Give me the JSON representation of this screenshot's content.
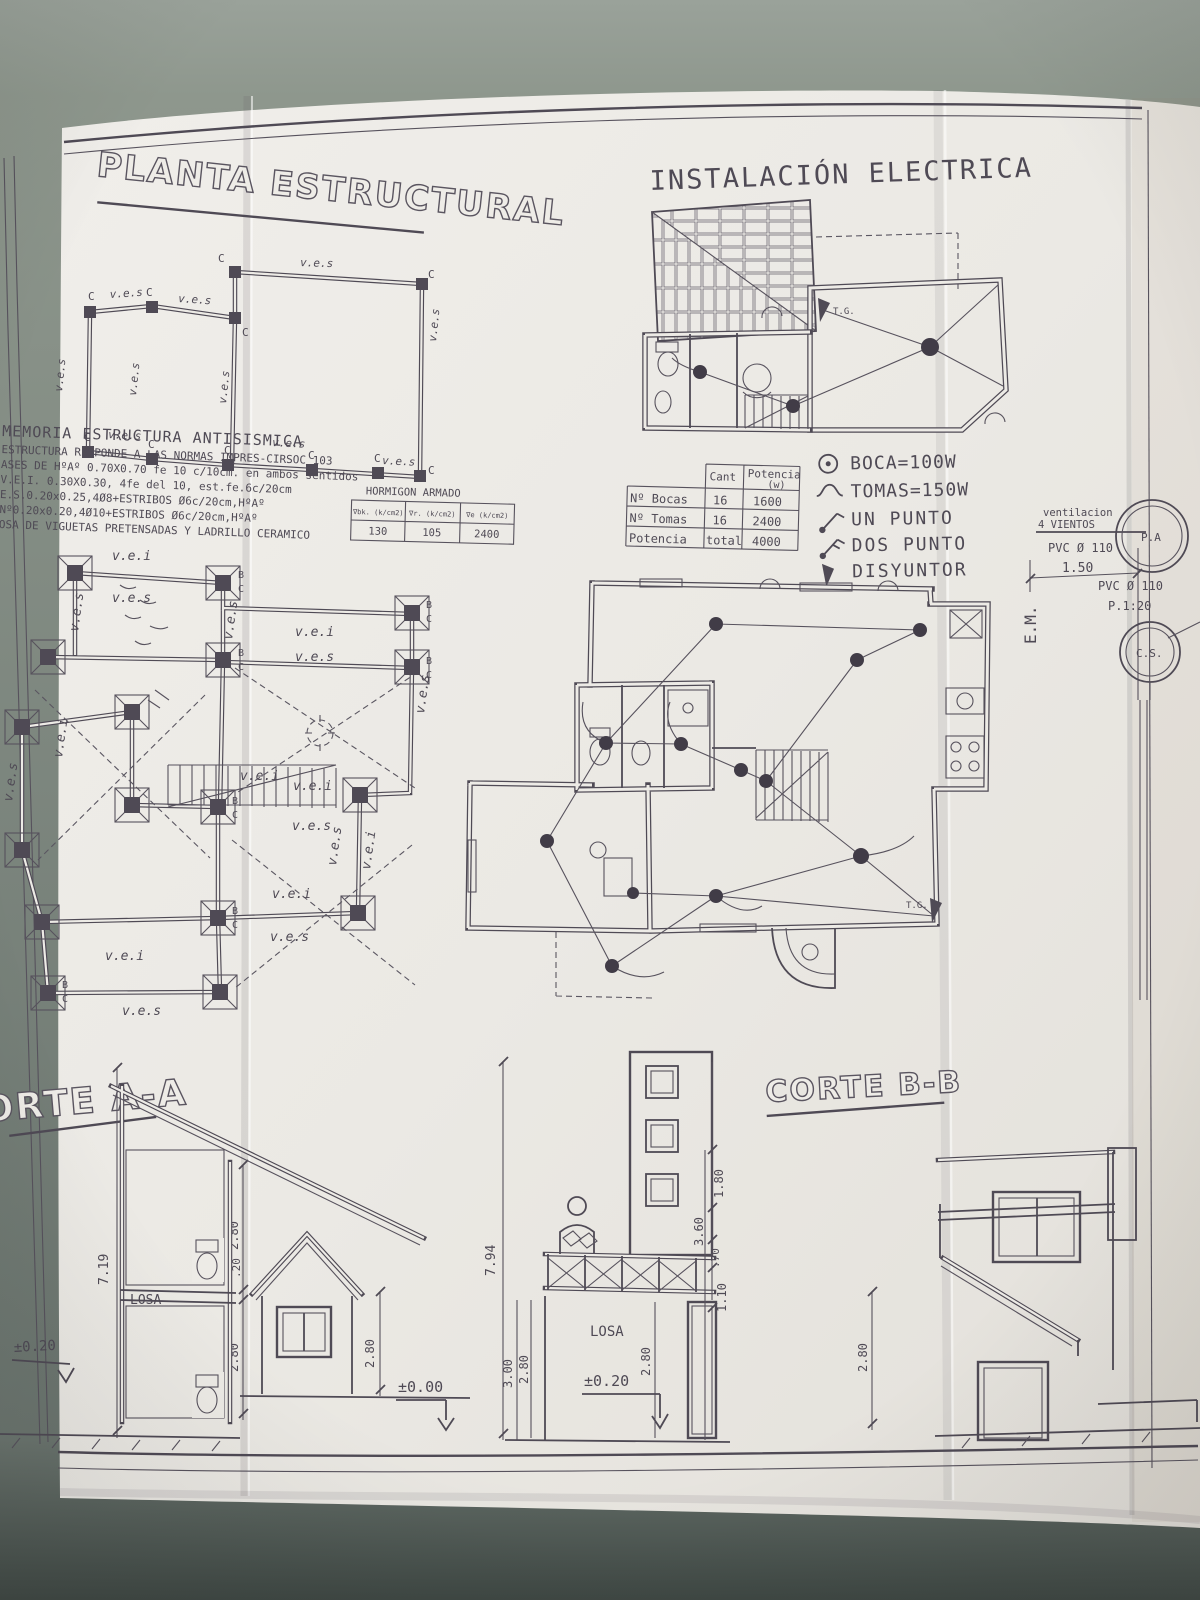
{
  "colors": {
    "table_surface": "#8e978d",
    "paper": "#edebe6",
    "ink": "#4f4a55"
  },
  "titles": {
    "planta": "PLANTA ESTRUCTURAL",
    "electrica": "INSTALACIÓN ELECTRICA",
    "corte_aa": "ORTE A-A",
    "corte_bb": "CORTE B-B"
  },
  "memoria": {
    "line1": "MEMORIA  ESTRUCTURA  ANTISISMICA",
    "line2": "ESTRUCTURA RESPONDE A LAS NORMAS IMPRES-CIRSOC 103",
    "line3": "ASES DE HºAº 0.70X0.70 fe 10 c/10cm. en ambos sentidos",
    "line4": "V.E.I. 0.30X0.30, 4fe del 10, est.fe.6c/20cm",
    "line5": "E.S.0.20x0.25,4Ø8+ESTRIBOS Ø6c/20cm,HºAº",
    "line6": "Nº0.20x0.20,4Ø10+ESTRIBOS Ø6c/20cm,HºAº",
    "line7": "OSA DE VIGUETAS PRETENSADAS Y LADRILLO CERAMICO"
  },
  "hormigon_table": {
    "title": "HORMIGON ARMADO",
    "headers": [
      "∇bk. (k/cm2)",
      "∇r. (k/cm2)",
      "∇e (k/cm2)"
    ],
    "values": [
      "130",
      "105",
      "2400"
    ]
  },
  "potencia_table": {
    "col_cant": "Cant",
    "col_potencia": "Potencia",
    "col_potencia_unit": "(w)",
    "rows": [
      {
        "label": "Nº Bocas",
        "cant": "16",
        "potencia": "1600"
      },
      {
        "label": "Nº Tomas",
        "cant": "16",
        "potencia": "2400"
      },
      {
        "label": "Potencia",
        "cant": "total",
        "potencia": "4000"
      }
    ]
  },
  "legend": {
    "boca": "BOCA=100W",
    "tomas": "TOMAS=150W",
    "un_punto": "UN PUNTO",
    "dos_punto": "DOS PUNTO",
    "disyuntor": "DISYUNTOR"
  },
  "ventilation": {
    "line1": "ventilacion",
    "line2": "4 VIENTOS",
    "pvc1": "PVC Ø 110",
    "dim": "1.50",
    "pa": "P.A",
    "pvc2": "PVC Ø 110",
    "pendiente": "P.1:20",
    "cs": "C.S.",
    "em": "E.M."
  },
  "plan_labels": {
    "ves": "v.e.s",
    "vei": "v.e.i",
    "c": "C",
    "b": "B",
    "tg": "T.G."
  },
  "corte_aa": {
    "losa": "LOSA",
    "dim_719": "7.19",
    "dim_20": ".20",
    "dim_280": "2.80",
    "level_000": "±0.00",
    "level_020": "±0.20"
  },
  "corte_bb": {
    "losa": "LOSA",
    "dim_794": "7.94",
    "dim_300": "3.00",
    "dim_280": "2.80",
    "dim_180": "1.80",
    "dim_360": "3.60",
    "dim_70": ".70",
    "dim_110": "1.10",
    "level_020": "±0.20"
  }
}
